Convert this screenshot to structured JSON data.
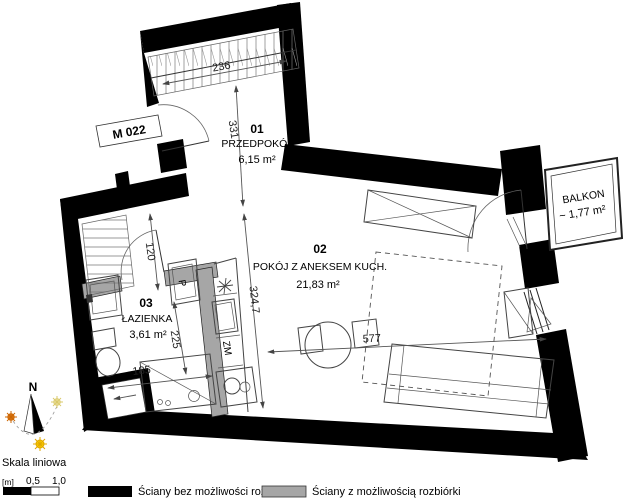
{
  "unit_label": "M 022",
  "rooms": {
    "hall": {
      "number": "01",
      "name": "PRZEDPOKÓJ",
      "area": "6,15 m²"
    },
    "living": {
      "number": "02",
      "name": "POKÓJ Z ANEKSEM KUCH.",
      "area": "21,83 m²"
    },
    "bath": {
      "number": "03",
      "name": "ŁAZIENKA",
      "area": "3,61 m²"
    }
  },
  "balcony": {
    "name": "BALKON",
    "area": "~ 1,77 m²"
  },
  "dims": {
    "wardrobe": "236",
    "hall_length": "331",
    "corridor": "120",
    "bath_width": "185",
    "bath_depth": "225",
    "room_depth": "324,7",
    "room_width": "577"
  },
  "fixtures": {
    "washer": "P",
    "kitchen_sink": "ZM"
  },
  "compass": {
    "north": "N"
  },
  "scalebar": {
    "title": "Skala liniowa",
    "unit": "[m]",
    "tick_half": "0,5",
    "tick_one": "1,0"
  },
  "legend": {
    "solid_label": "Ściany bez możliwości rozbiórki",
    "removable_label": "Ściany z możliwością rozbiórki"
  },
  "colors": {
    "wall": "#000000",
    "removable_fill": "#a6a6a6",
    "line": "#444444"
  }
}
